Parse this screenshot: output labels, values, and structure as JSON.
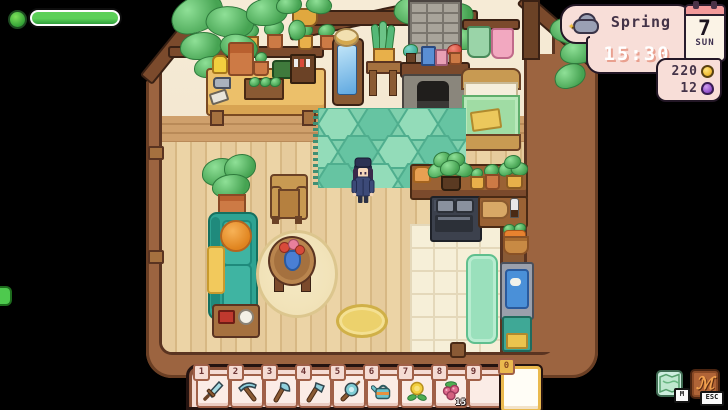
{
  "hud": {
    "health_bar": {
      "fill_percent": 100,
      "fill_color": "#44c24c",
      "icon": "health-face-icon"
    },
    "info_panel": {
      "season": "Spring",
      "time": "15:30",
      "weather_icon": "cloud-sparkle-weather-icon",
      "calendar": {
        "day": "7",
        "weekday": "SUN"
      }
    },
    "wallet": {
      "gold": {
        "amount": "220",
        "icon": "gold-coin-icon",
        "color": "#f2c23e"
      },
      "essence": {
        "amount": "12",
        "icon": "essence-orb-icon",
        "color": "#9b59d0"
      }
    }
  },
  "hotbar": {
    "slots": [
      {
        "key": "1",
        "item": "sword"
      },
      {
        "key": "2",
        "item": "pickaxe"
      },
      {
        "key": "3",
        "item": "axe"
      },
      {
        "key": "4",
        "item": "hoe"
      },
      {
        "key": "5",
        "item": "fishing-rod"
      },
      {
        "key": "6",
        "item": "watering-can"
      },
      {
        "key": "7",
        "item": "yellow-flower"
      },
      {
        "key": "8",
        "item": "berries",
        "count": "15"
      },
      {
        "key": "9",
        "item": "empty"
      },
      {
        "key": "0",
        "item": "empty",
        "selected": true
      }
    ]
  },
  "shortcut_buttons": {
    "map": {
      "key_label": "M",
      "icon": "map-icon"
    },
    "menu": {
      "key_label": "ESC",
      "icon": "menu-icon"
    }
  },
  "colors": {
    "panel_pink": "#f8ded8",
    "panel_outline": "#231726",
    "rug_teal": "#7fd0ad",
    "couch_teal": "#2ea392",
    "floor_tan": "#e6cb9c",
    "frame_brown": "#9c6440"
  }
}
